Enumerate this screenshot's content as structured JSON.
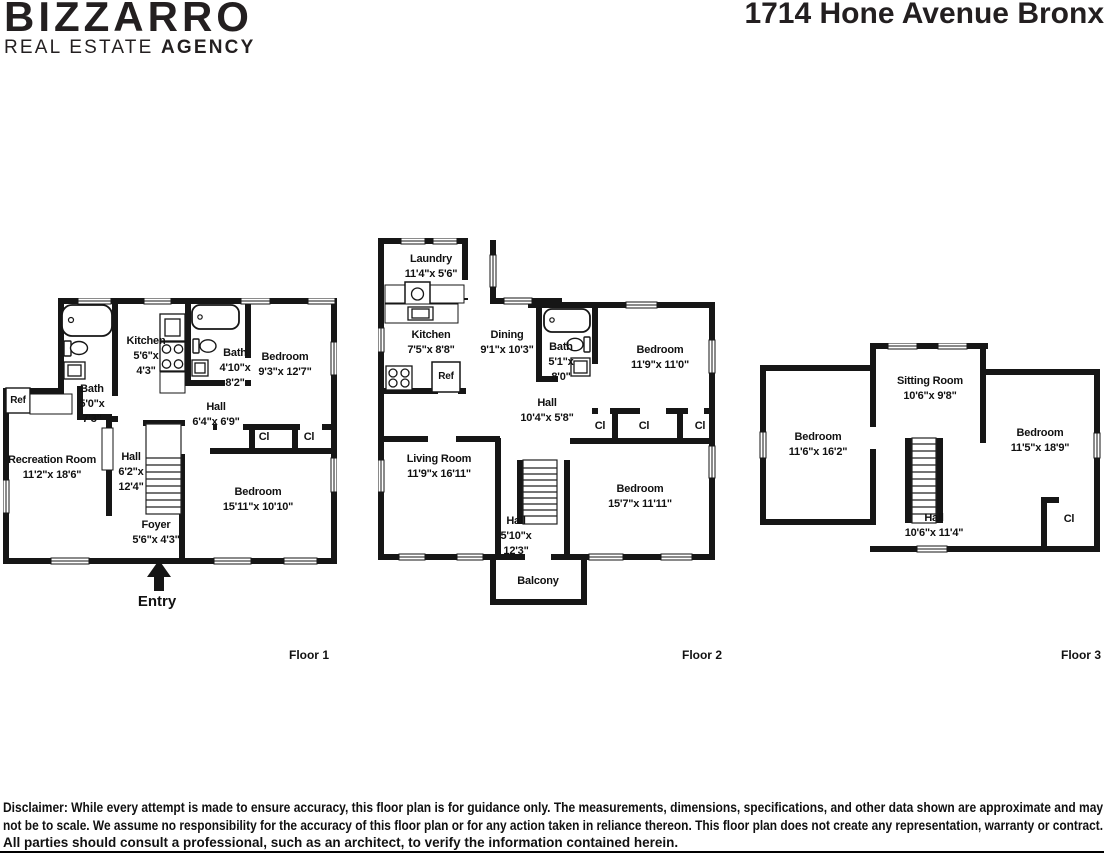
{
  "header": {
    "logo_line1": "BIZZARRO",
    "logo_line2_regular": "REAL ESTATE ",
    "logo_line2_bold": "AGENCY",
    "title": "1714 Hone Avenue Bronx"
  },
  "floor1": {
    "caption": "Floor 1",
    "entry_label": "Entry",
    "rooms": {
      "kitchen": {
        "name": "Kitchen",
        "dim1": "5'6\"x",
        "dim2": "4'3\""
      },
      "bath_upper": {
        "name": "Bath",
        "dim1": "4'10\"x",
        "dim2": "8'2\""
      },
      "bedroom_upper": {
        "name": "Bedroom",
        "dims": "9'3\"x 12'7\""
      },
      "bath_lower": {
        "name": "Bath",
        "dim1": "5'0\"x",
        "dim2": "7'3\""
      },
      "ref": {
        "name": "Ref"
      },
      "hall_center": {
        "name": "Hall",
        "dims": "6'4\"x 6'9\""
      },
      "hall_west": {
        "name": "Hall",
        "dim1": "6'2\"x",
        "dim2": "12'4\""
      },
      "recreation_room": {
        "name": "Recreation Room",
        "dims": "11'2\"x 18'6\""
      },
      "closet_left": {
        "name": "Cl"
      },
      "closet_right": {
        "name": "Cl"
      },
      "bedroom_lower": {
        "name": "Bedroom",
        "dims": "15'11\"x 10'10\""
      },
      "foyer": {
        "name": "Foyer",
        "dims": "5'6\"x 4'3\""
      }
    }
  },
  "floor2": {
    "caption": "Floor 2",
    "rooms": {
      "laundry": {
        "name": "Laundry",
        "dims": "11'4\"x 5'6\""
      },
      "kitchen": {
        "name": "Kitchen",
        "dims": "7'5\"x 8'8\""
      },
      "ref": {
        "name": "Ref"
      },
      "dining": {
        "name": "Dining",
        "dims": "9'1\"x 10'3\""
      },
      "bath": {
        "name": "Bath",
        "dim1": "5'1\"x",
        "dim2": "8'0\""
      },
      "bedroom_upper": {
        "name": "Bedroom",
        "dims": "11'9\"x 11'0\""
      },
      "hall_upper": {
        "name": "Hall",
        "dims": "10'4\"x 5'8\""
      },
      "closet_1": {
        "name": "Cl"
      },
      "closet_2": {
        "name": "Cl"
      },
      "closet_3": {
        "name": "Cl"
      },
      "living_room": {
        "name": "Living Room",
        "dims": "11'9\"x 16'11\""
      },
      "hall_lower": {
        "name": "Hall",
        "dim1": "5'10\"x",
        "dim2": "12'3\""
      },
      "bedroom_lower": {
        "name": "Bedroom",
        "dims": "15'7\"x 11'11\""
      },
      "balcony": {
        "name": "Balcony"
      }
    }
  },
  "floor3": {
    "caption": "Floor 3",
    "rooms": {
      "bedroom_west": {
        "name": "Bedroom",
        "dims": "11'6\"x 16'2\""
      },
      "sitting_room": {
        "name": "Sitting Room",
        "dims": "10'6\"x 9'8\""
      },
      "bedroom_east": {
        "name": "Bedroom",
        "dims": "11'5\"x 18'9\""
      },
      "hall": {
        "name": "Hall",
        "dims": "10'6\"x 11'4\""
      },
      "closet": {
        "name": "Cl"
      }
    }
  },
  "disclaimer": {
    "line1": "Disclaimer: While every attempt is made to ensure accuracy, this floor plan is for guidance only. The measurements, dimensions, specifications, and other data shown are approximate and may",
    "line2": "not be to scale. We assume no responsibility for the accuracy of this floor plan or for any action taken in reliance thereon. This floor plan does not create any representation, warranty or contract.",
    "line3": "All parties should consult a professional, such as an architect, to verify the information contained herein."
  }
}
